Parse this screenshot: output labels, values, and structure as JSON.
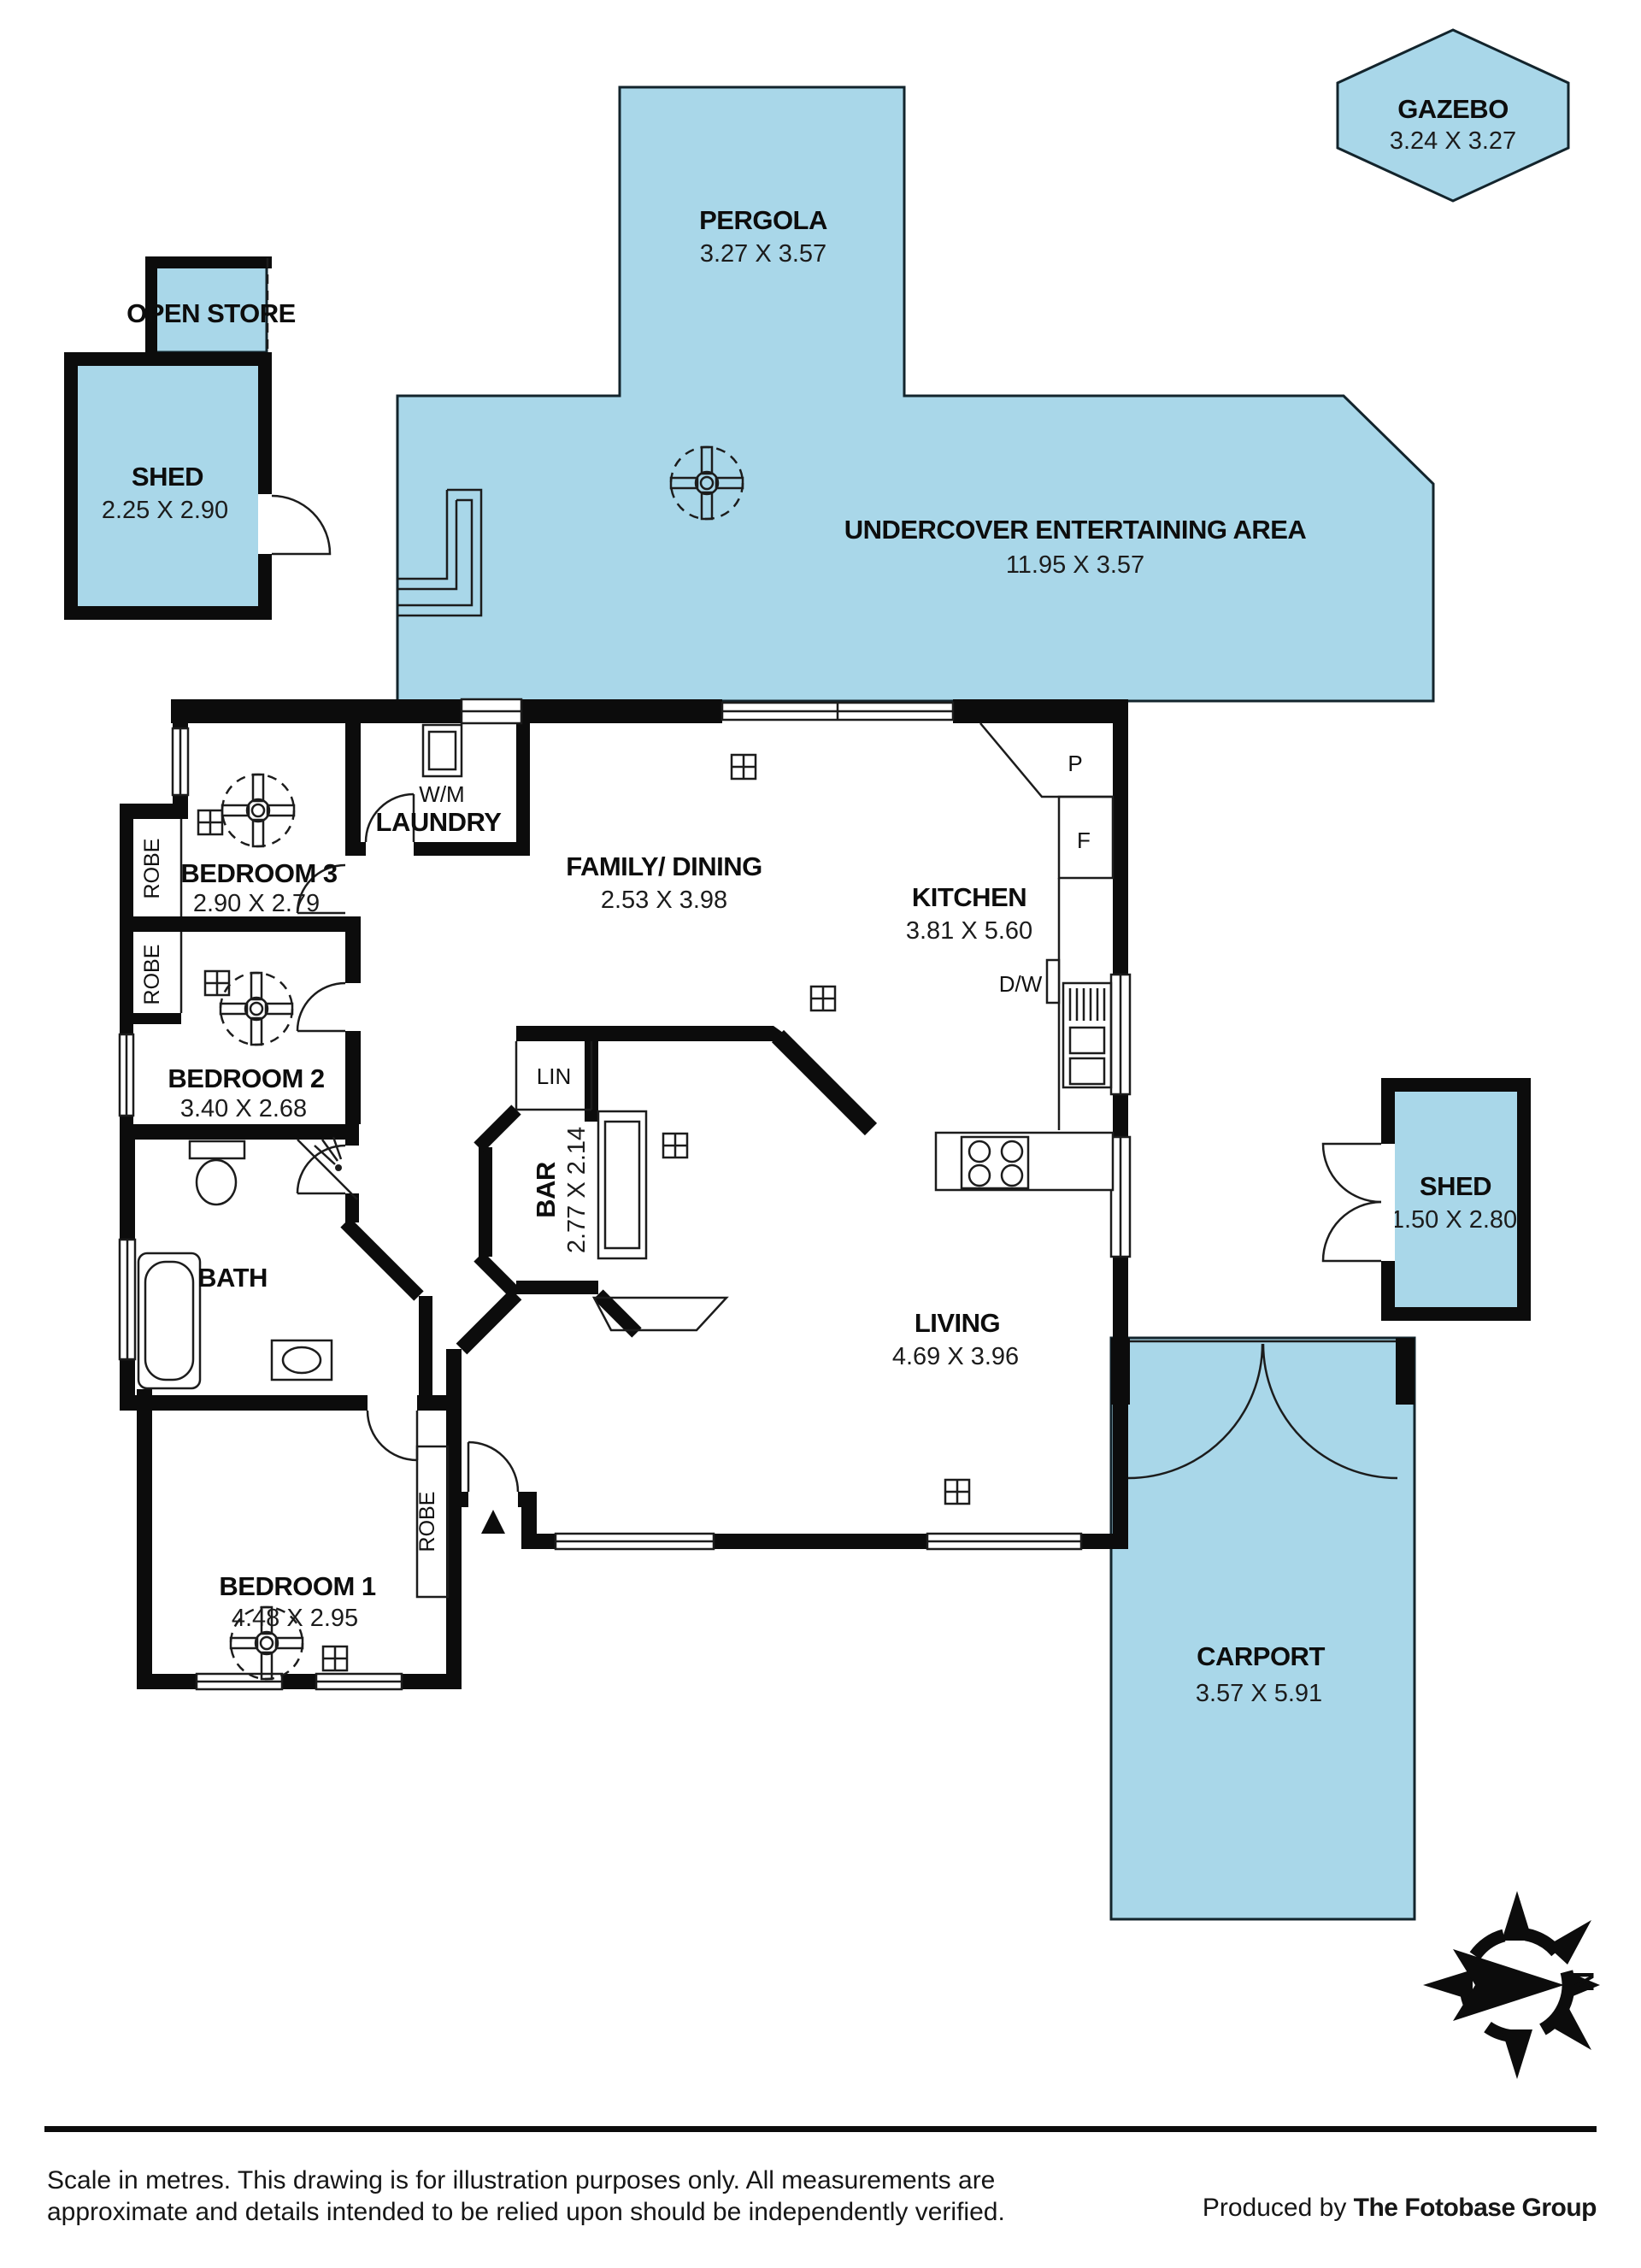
{
  "plan": {
    "outdoor": {
      "pergola": {
        "label": "PERGOLA",
        "dims": "3.27 X 3.57"
      },
      "gazebo": {
        "label": "GAZEBO",
        "dims": "3.24 X 3.27"
      },
      "open_store": {
        "label": "OPEN STORE"
      },
      "shed_left": {
        "label": "SHED",
        "dims": "2.25 X 2.90"
      },
      "undercover": {
        "label": "UNDERCOVER ENTERTAINING AREA",
        "dims": "11.95 X 3.57"
      },
      "shed_right": {
        "label": "SHED",
        "dims": "1.50 X 2.80"
      },
      "carport": {
        "label": "CARPORT",
        "dims": "3.57 X 5.91"
      }
    },
    "rooms": {
      "bedroom3": {
        "label": "BEDROOM 3",
        "dims": "2.90 X 2.79"
      },
      "bedroom2": {
        "label": "BEDROOM 2",
        "dims": "3.40 X 2.68"
      },
      "bedroom1": {
        "label": "BEDROOM 1",
        "dims": "4.48 X 2.95"
      },
      "bath": {
        "label": "BATH"
      },
      "laundry": {
        "label": "LAUNDRY"
      },
      "family_dining": {
        "label": "FAMILY/ DINING",
        "dims": "2.53 X 3.98"
      },
      "kitchen": {
        "label": "KITCHEN",
        "dims": "3.81 X 5.60"
      },
      "living": {
        "label": "LIVING",
        "dims": "4.69 X 3.96"
      },
      "bar": {
        "label": "BAR",
        "dims": "2.77 X 2.14"
      }
    },
    "closets": {
      "robe": "ROBE",
      "lin": "LIN"
    },
    "appliances": {
      "washing_machine": "W/M",
      "pantry": "P",
      "fridge": "F",
      "dishwasher": "D/W"
    },
    "compass": {
      "north": "N"
    },
    "colors": {
      "area_fill": "#a9d7e9",
      "wall": "#0c0c0c"
    }
  },
  "footer": {
    "line1": "Scale in metres. This drawing is for illustration purposes only. All measurements are",
    "line2": "approximate and details intended to be relied upon should be independently verified.",
    "produced_by": "Produced by ",
    "brand": "The Fotobase Group"
  }
}
